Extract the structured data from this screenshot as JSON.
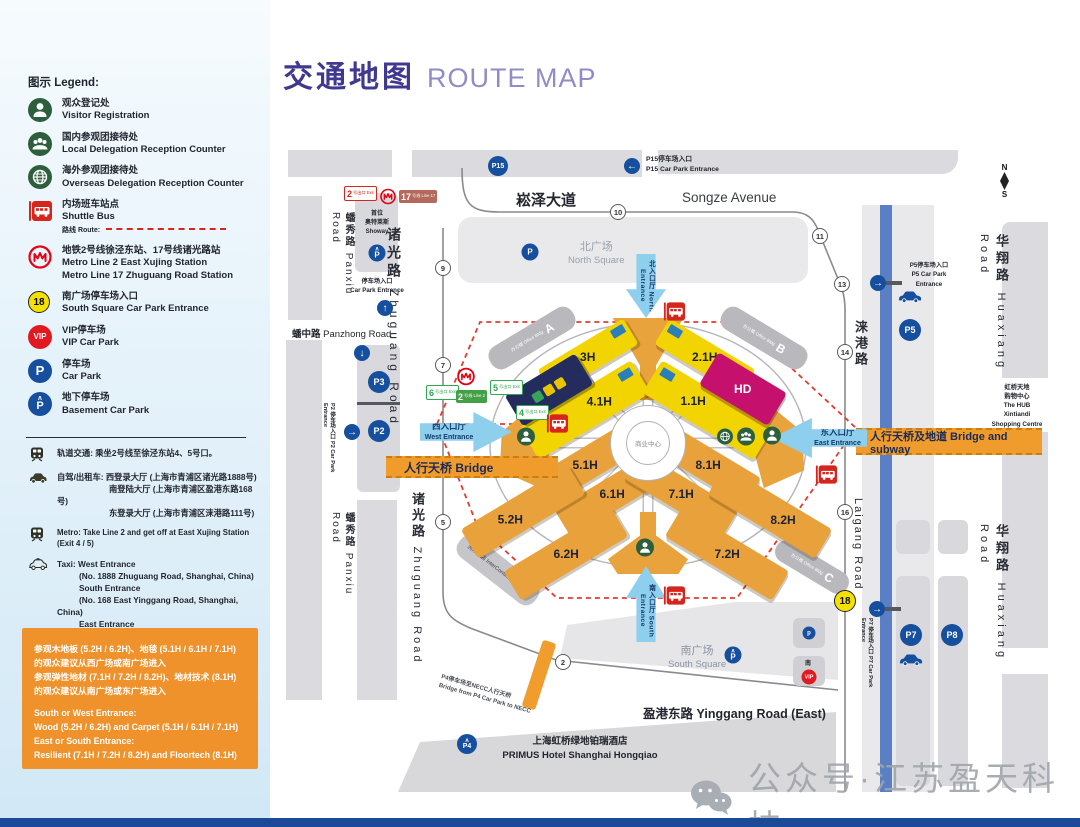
{
  "title": {
    "zh": "交通地图",
    "en": "ROUTE MAP"
  },
  "legend": {
    "heading": "图示 Legend:",
    "items": [
      {
        "zh": "观众登记处",
        "en": "Visitor Registration"
      },
      {
        "zh": "国内参观团接待处",
        "en": "Local Delegation Reception Counter"
      },
      {
        "zh": "海外参观团接待处",
        "en": "Overseas Delegation Reception Counter"
      },
      {
        "zh": "内场班车站点",
        "en": "Shuttle Bus",
        "route": "路线 Route:"
      },
      {
        "zh": "地铁2号线徐泾东站、17号线诸光路站",
        "en": "Metro Line 2 East Xujing Station",
        "en2": "Metro Line 17 Zhuguang Road Station"
      },
      {
        "zh": "南广场停车场入口",
        "en": "South Square Car Park Entrance",
        "badge": "18"
      },
      {
        "zh": "VIP停车场",
        "en": "VIP Car Park",
        "badge": "VIP"
      },
      {
        "zh": "停车场",
        "en": "Car Park",
        "badge": "P"
      },
      {
        "zh": "地下停车场",
        "en": "Basement Car Park",
        "badge": "P"
      }
    ],
    "notes": {
      "rail_zh": "轨道交通: 乘坐2号线至徐泾东站4、5号口。",
      "drive_l1": "自驾/出租车: 西登录大厅 (上海市青浦区诸光路1888号)",
      "drive_l2": "南登陆大厅 (上海市青浦区盈港东路168号)",
      "drive_l3": "东登录大厅 (上海市青浦区涞港路111号)",
      "metro_en": "Metro: Take Line 2 and get off at East Xujing Station (Exit 4 / 5)",
      "taxi_l1": "Taxi:  West Entrance",
      "taxi_l2": "(No. 1888 Zhuguang Road, Shanghai, China)",
      "taxi_l3": "South Entrance",
      "taxi_l4": "(No. 168 East Yinggang Road, Shanghai, China)",
      "taxi_l5": "East Entrance",
      "taxi_l6": "(No. 111 Laigang Road, Shanghai, China)"
    },
    "notice": {
      "zh1": "参观木地板 (5.2H / 6.2H)、地毯 (5.1H / 6.1H / 7.1H)",
      "zh2": "的观众建议从西广场或南广场进入",
      "zh3": "参观弹性地材 (7.1H / 7.2H / 8.2H)、地材技术 (8.1H)",
      "zh4": "的观众建议从南广场或东广场进入",
      "en1": "South or West Entrance:",
      "en2": "Wood (5.2H / 6.2H) and Carpet (5.1H / 6.1H / 7.1H)",
      "en3": "East or South Entrance:",
      "en4": "Resilient (7.1H / 7.2H / 8.2H) and Floortech (8.1H)"
    }
  },
  "map": {
    "roads": {
      "songze_zh": "崧泽大道",
      "songze_en": "Songze Avenue",
      "panxiu_zh": "蟠秀路",
      "panxiu_en": "Panxiu Road",
      "zhuguang_zh": "诸光路",
      "zhuguang_en": "Zhuguang Road",
      "panzhong_zh": "蟠中路",
      "panzhong_en": "Panzhong Road",
      "laigang_zh": "涞港路",
      "laigang_en": "Laigang Road",
      "huaxiang_zh": "华翔路",
      "huaxiang_en": "Huaxiang Road",
      "yinggang_zh": "盈港东路",
      "yinggang_en": "Yinggang Road (East)"
    },
    "gates": {
      "g2": "2",
      "g5": "5",
      "g7": "7",
      "g9": "9",
      "g10": "10",
      "g11": "11",
      "g13": "13",
      "g14": "14",
      "g16": "16",
      "g18": "18"
    },
    "halls": {
      "h3": "3H",
      "h21": "2.1H",
      "h41": "4.1H",
      "h11": "1.1H",
      "h51": "5.1H",
      "h81": "8.1H",
      "h61": "6.1H",
      "h71": "7.1H",
      "h52": "5.2H",
      "h82": "8.2H",
      "h62": "6.2H",
      "h72": "7.2H"
    },
    "entrances": {
      "north_zh": "北入口厅",
      "north_en": "North Entrance",
      "south_zh": "南入口厅",
      "south_en": "South Entrance",
      "west_zh": "西入口厅",
      "west_en": "West Entrance",
      "east_zh": "东入口厅",
      "east_en": "East Entrance"
    },
    "bridges": {
      "west": "人行天桥 Bridge",
      "east": "人行天桥及地道 Bridge and subway"
    },
    "badges": {
      "exit2": {
        "num": "2",
        "txt": "号出口 Exit"
      },
      "line17": {
        "num": "17",
        "txt": "号线 Line 17"
      },
      "line2": {
        "num": "2",
        "txt": "号线 Line 2"
      },
      "exit4": {
        "num": "4",
        "txt": "号出口 Exit"
      },
      "exit5": {
        "num": "5",
        "txt": "号出口 Exit"
      },
      "exit6": {
        "num": "6",
        "txt": "号出口 Exit"
      }
    },
    "squares": {
      "north_zh": "北广场",
      "north_en": "North Square",
      "south_zh": "南广场",
      "south_en": "South Square",
      "center": "商业中心"
    },
    "office": {
      "label": "办公楼 Office Bldg",
      "a": "A",
      "b": "B",
      "c": "C"
    },
    "parks": {
      "p15": "P15",
      "p5": "P5",
      "p3": "P3",
      "p2": "P2",
      "p7": "P7",
      "p8": "P8",
      "p4": "P4",
      "p": "P",
      "p_small": "p",
      "vip": "VIP",
      "south": "南"
    },
    "park_entrances": {
      "p15_zh": "P15停车场入口",
      "p15_en": "P15 Car Park Entrance",
      "p5_zh": "P5停车场入口",
      "p5_en": "P5 Car Park Entrance",
      "p2_zh": "P2 停车场入口",
      "p2_en": "P2 Car Park Entrance",
      "p7_zh": "P7 停车场入口",
      "p7_en": "P7 Car Park Entrance",
      "showay_zh": "停车场入口",
      "showay_en": "Car Park Entrance"
    },
    "places": {
      "showay1": "首位",
      "showay2": "奥特莱斯",
      "showay3": "Showay",
      "hub1": "虹桥天地",
      "hub2": "购物中心",
      "hub3": "The HUB",
      "hub4": "Xintiandi",
      "hub5": "Shopping Centre",
      "intercontinental": "洲际酒店 InterContinental Hotel",
      "hotel_zh": "上海虹桥绿地铂瑞酒店",
      "hotel_en": "PRIMUS Hotel Shanghai Hongqiao",
      "p4bridge_zh": "P4停车场至NECC人行天桥",
      "p4bridge_en": "Bridge from P4 Car Park to NECC",
      "hd": "HD"
    },
    "compass": {
      "n": "N",
      "s": "S"
    }
  },
  "watermark": {
    "text": "公众号·江苏盈天科技"
  },
  "colors": {
    "hall_yellow": "#f2d403",
    "hall_orange": "#e9a23b",
    "accent_orange": "#f0922b",
    "park_blue": "#164f9e",
    "metro_red": "#e60012",
    "icon_green": "#2d5f3c",
    "arrow_blue": "#8ecfee",
    "title_purple": "#3f3a8f",
    "route_red": "#e63a2e"
  }
}
